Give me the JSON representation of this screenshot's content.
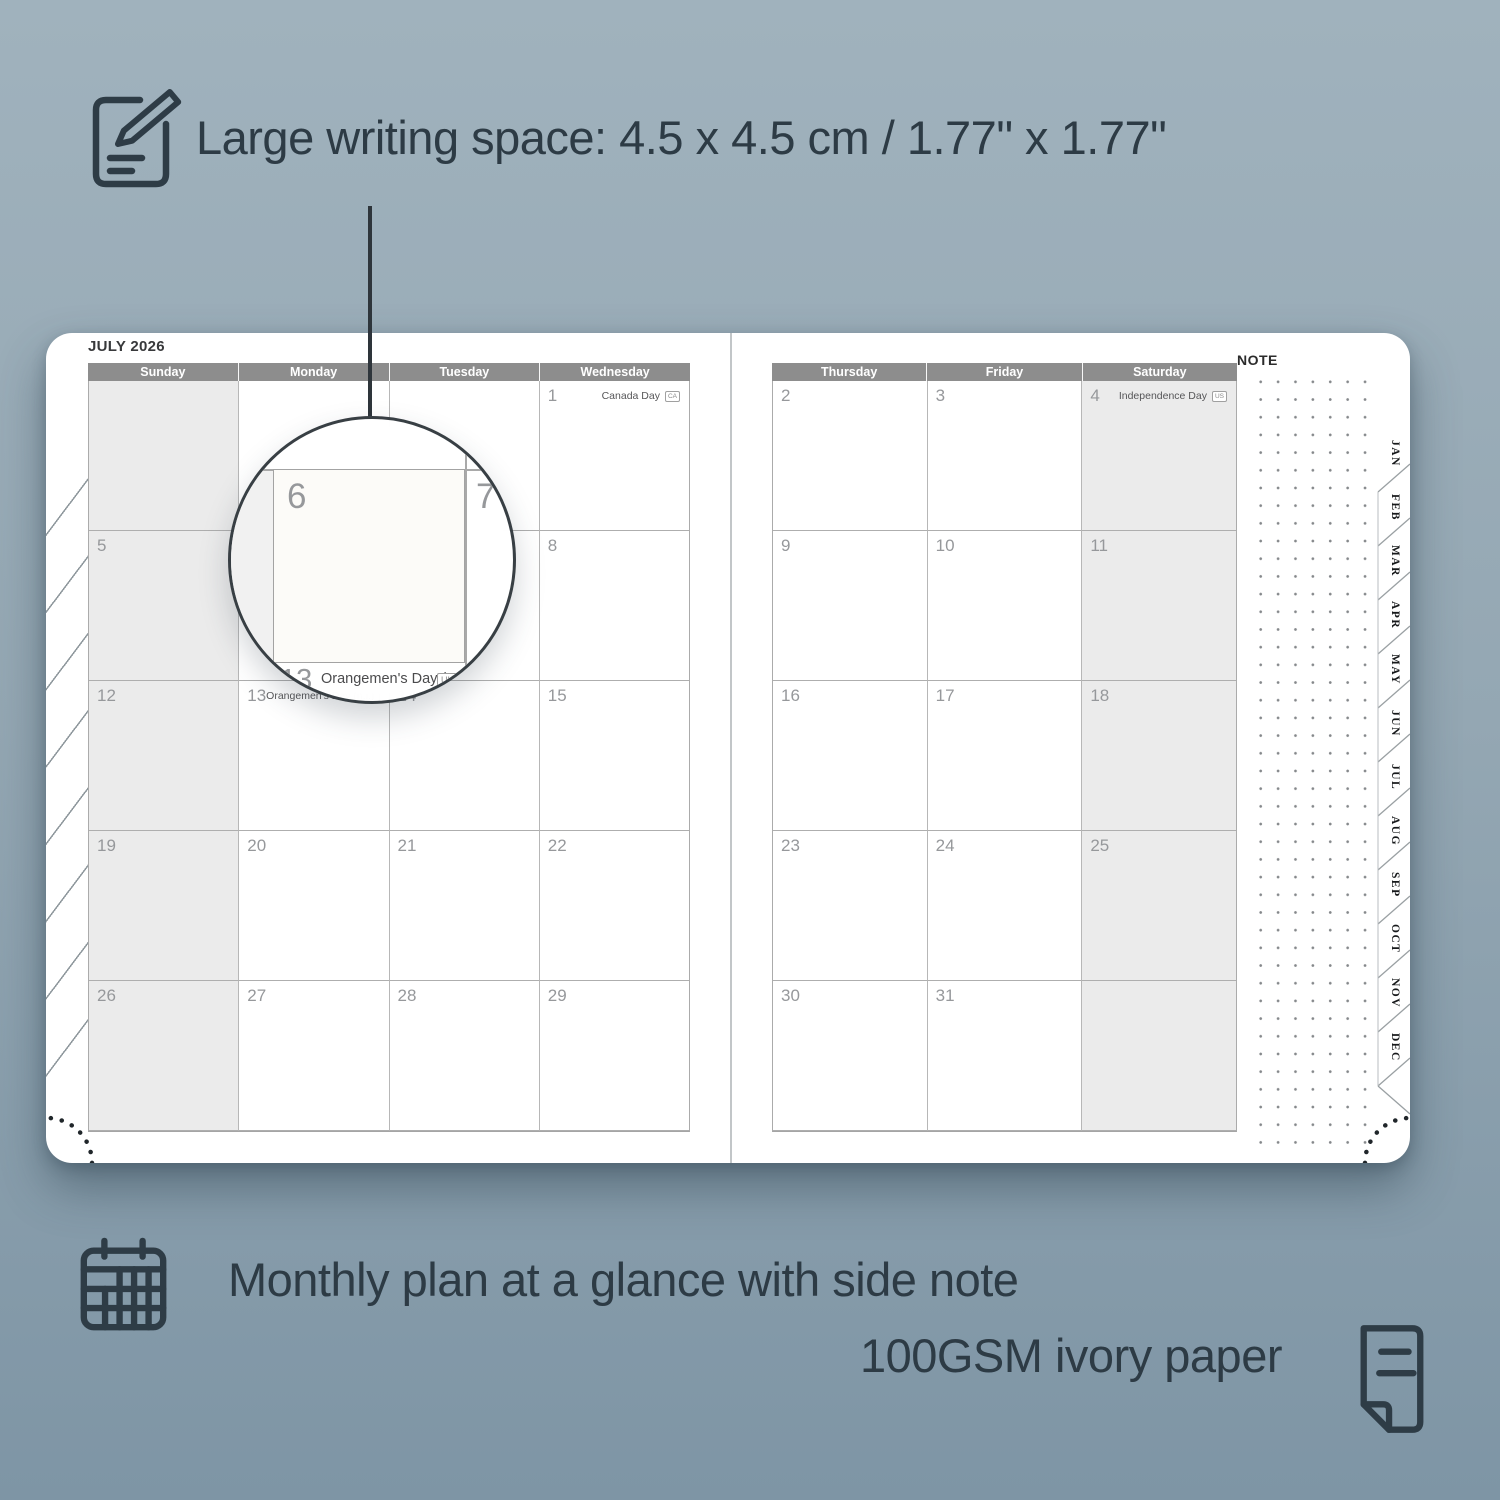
{
  "features": {
    "writing_space": {
      "text": "Large writing space: 4.5 x 4.5 cm / 1.77\" x 1.77\""
    },
    "monthly_plan": {
      "text": "Monthly plan at a glance with side note"
    },
    "paper": {
      "text": "100GSM ivory paper"
    }
  },
  "planner": {
    "left_page": {
      "title": "JULY 2026",
      "headers": [
        "Sunday",
        "Monday",
        "Tuesday",
        "Wednesday"
      ],
      "weeks": [
        [
          {
            "day": ""
          },
          {
            "day": ""
          },
          {
            "day": ""
          },
          {
            "day": "1",
            "holiday": "Canada Day",
            "badge": "CA"
          }
        ],
        [
          {
            "day": "5"
          },
          {
            "day": "6"
          },
          {
            "day": "7"
          },
          {
            "day": "8"
          }
        ],
        [
          {
            "day": "12"
          },
          {
            "day": "13",
            "holiday": "Orangemen's Day (n.i.)",
            "badge": "UK"
          },
          {
            "day": "14"
          },
          {
            "day": "15"
          }
        ],
        [
          {
            "day": "19"
          },
          {
            "day": "20"
          },
          {
            "day": "21"
          },
          {
            "day": "22"
          }
        ],
        [
          {
            "day": "26"
          },
          {
            "day": "27"
          },
          {
            "day": "28"
          },
          {
            "day": "29"
          }
        ]
      ],
      "shaded_column": 0
    },
    "right_page": {
      "headers": [
        "Thursday",
        "Friday",
        "Saturday"
      ],
      "weeks": [
        [
          {
            "day": "2"
          },
          {
            "day": "3"
          },
          {
            "day": "4",
            "holiday": "Independence Day",
            "badge": "US"
          }
        ],
        [
          {
            "day": "9"
          },
          {
            "day": "10"
          },
          {
            "day": "11"
          }
        ],
        [
          {
            "day": "16"
          },
          {
            "day": "17"
          },
          {
            "day": "18"
          }
        ],
        [
          {
            "day": "23"
          },
          {
            "day": "24"
          },
          {
            "day": "25"
          }
        ],
        [
          {
            "day": "30"
          },
          {
            "day": "31"
          },
          {
            "day": ""
          }
        ]
      ],
      "shaded_column": 2
    },
    "note_label": "NOTE",
    "month_tabs": [
      "JAN",
      "FEB",
      "MAR",
      "APR",
      "MAY",
      "JUN",
      "JUL",
      "AUG",
      "SEP",
      "OCT",
      "NOV",
      "DEC"
    ]
  },
  "magnifier": {
    "day": "6",
    "adjacent_day": "7",
    "below_day": "13",
    "holiday": "Orangemen's Day (n.i.)",
    "badge": "UK"
  },
  "colors": {
    "background_top": "#a0b2bd",
    "background_bottom": "#7e95a5",
    "accent_dark": "#2e3c46",
    "header_gray": "#8d8d8d",
    "shaded_cell": "#ebebeb"
  }
}
